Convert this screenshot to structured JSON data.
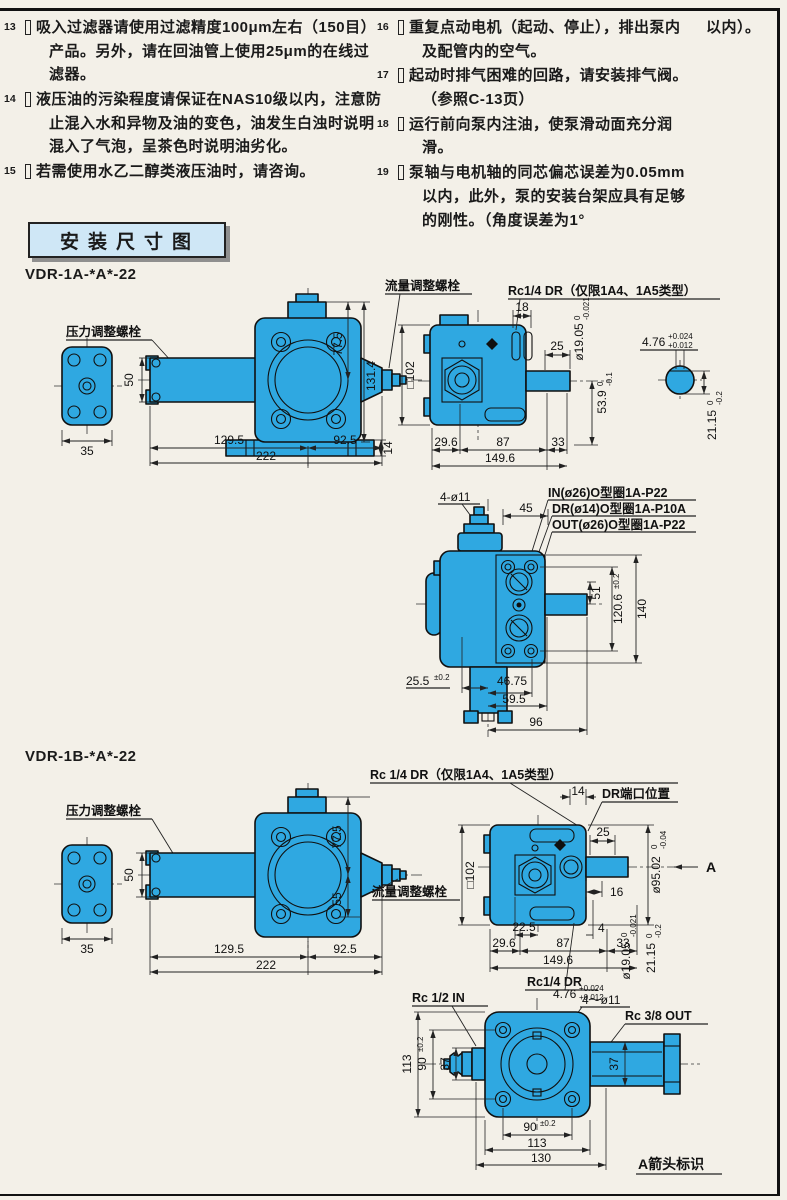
{
  "notes": {
    "col1": [
      {
        "num": "13",
        "text": "吸入过滤器请使用过滤精度100μm左右（150目）产品。另外，请在回油管上使用25μm的在线过滤器。"
      },
      {
        "num": "14",
        "text": "液压油的污染程度请保证在NAS10级以内，注意防止混入水和异物及油的变色，油发生白浊时说明混入了气泡，呈茶色时说明油劣化。"
      },
      {
        "num": "15",
        "text": "若需使用水乙二醇类液压油时，请咨询。"
      }
    ],
    "col2": [
      {
        "num": "16",
        "text": "重复点动电机（起动、停止），排出泵内及配管内的空气。"
      },
      {
        "num": "17",
        "text": "起动时排气困难的回路，请安装排气阀。（参照C-13页）"
      },
      {
        "num": "18",
        "text": "运行前向泵内注油，使泵滑动面充分润滑。"
      },
      {
        "num": "19",
        "text": "泵轴与电机轴的同芯偏芯误差为0.05mm以内，此外，泵的安装台架应具有足够的刚性。（角度误差为1°"
      }
    ],
    "cont": "以内）。"
  },
  "section_title": "安装尺寸图",
  "models": {
    "a": "VDR-1A-*A*-22",
    "b": "VDR-1B-*A*-22"
  },
  "labels": {
    "flow": "流量调整螺栓",
    "press": "压力调整螺栓",
    "rc14a": "Rc1/4 DR（仅限1A4、1A5类型）",
    "rc14b": "Rc 1/4 DR（仅限1A4、1A5类型）",
    "drport": "DR端口位置",
    "in": "IN(ø26)O型圈1A-P22",
    "dr": "DR(ø14)O型圈1A-P10A",
    "out": "OUT(ø26)O型圈1A-P22",
    "rc14dr": "Rc1/4 DR",
    "rc12in": "Rc 1/2  IN",
    "rc38out": "Rc 3/8  OUT",
    "aview": "A箭头标识",
    "a": "A"
  },
  "dims": {
    "d35": "35",
    "d50": "50",
    "d1295": "129.5",
    "d925": "92.5",
    "d222": "222",
    "d775": "77.5",
    "d1314": "131.4",
    "d14": "14",
    "d18": "18",
    "d25": "25",
    "sq102": "□102",
    "d296": "29.6",
    "d87": "87",
    "d33": "33",
    "d1496": "149.6",
    "d4o11": "4-ø11",
    "d45": "45",
    "d51": "51",
    "d140": "140",
    "d4675": "46.75",
    "d595": "59.5",
    "d96": "96",
    "d55": "55",
    "d16": "16",
    "d225": "22.5",
    "d4": "4",
    "d113": "113",
    "d37": "37",
    "d130": "130",
    "d4o11w": "4～ø11",
    "d90": "90"
  },
  "tols": {
    "s476": {
      "base": "4.76",
      "top": "+0.024",
      "bot": "+0.012"
    },
    "d1905": {
      "base": "ø19.05",
      "top": "0",
      "bot": "-0.021"
    },
    "d2115": {
      "base": "21.15",
      "top": "0",
      "bot": "-0.2"
    },
    "d539": {
      "base": "53.9",
      "top": "0",
      "bot": "-0.1"
    },
    "d9502": {
      "base": "ø95.02",
      "top": "0",
      "bot": "-0.04"
    },
    "d1206": {
      "base": "120.6",
      "sup": "±0.2"
    },
    "d255": {
      "base": "25.5",
      "sup": "±0.2"
    },
    "d90sup": "±0.2"
  }
}
